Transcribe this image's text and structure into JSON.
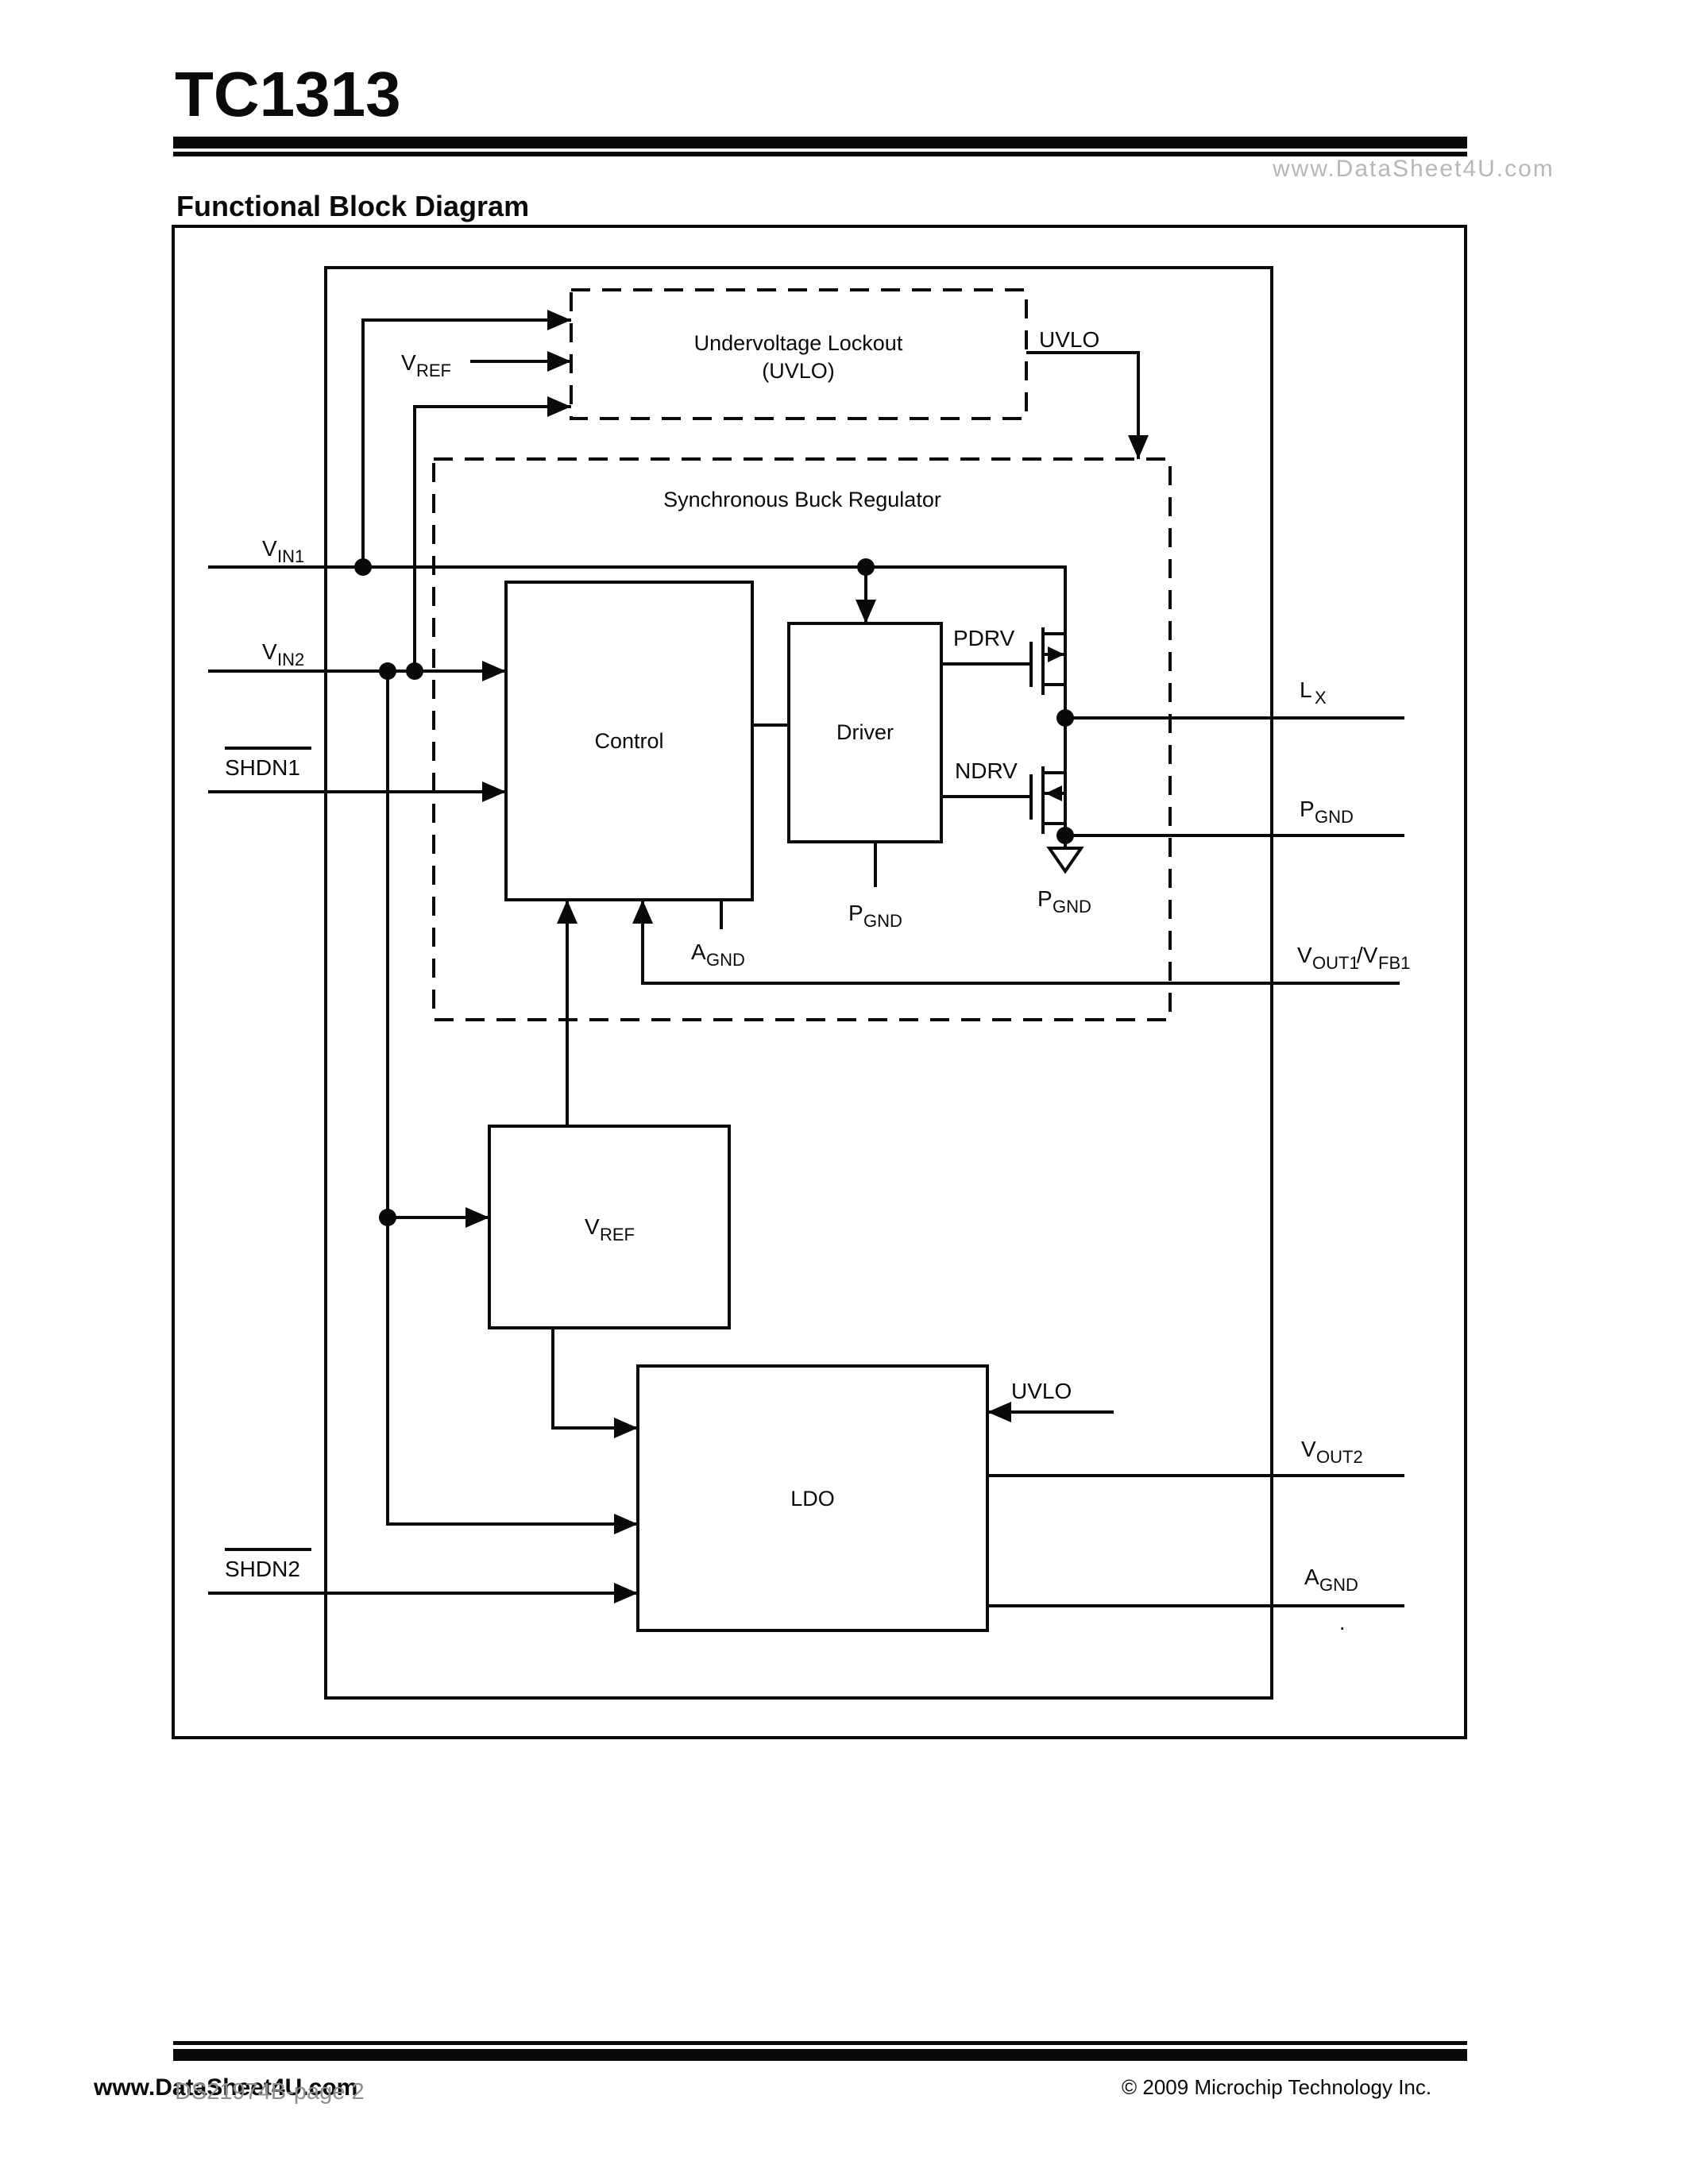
{
  "header": {
    "title": "TC1313",
    "watermark": "www.DataSheet4U.com",
    "section_title": "Functional Block Diagram"
  },
  "blocks": {
    "uvlo_line1": "Undervoltage Lockout",
    "uvlo_line2": "(UVLO)",
    "buck_title": "Synchronous Buck Regulator",
    "control": "Control",
    "driver": "Driver",
    "vref": {
      "main": "V",
      "sub": "REF"
    },
    "ldo": "LDO"
  },
  "pins": {
    "vin1": {
      "main": "V",
      "sub": "IN1"
    },
    "vin2": {
      "main": "V",
      "sub": "IN2"
    },
    "shdn1": "SHDN1",
    "shdn2": "SHDN2",
    "vref_in": {
      "main": "V",
      "sub": "REF"
    },
    "uvlo_out": "UVLO",
    "uvlo_ldo": "UVLO",
    "pdrv": "PDRV",
    "ndrv": "NDRV",
    "lx": {
      "main": "L",
      "sub": "X"
    },
    "pgnd_pin": {
      "main": "P",
      "sub": "GND"
    },
    "pgnd_fet": {
      "main": "P",
      "sub": "GND"
    },
    "pgnd_driver": {
      "main": "P",
      "sub": "GND"
    },
    "agnd_control": {
      "main": "A",
      "sub": "GND"
    },
    "agnd_ldo": {
      "main": "A",
      "sub": "GND"
    },
    "vout1": {
      "m1": "V",
      "s1": "OUT1",
      "m2": "/V",
      "s2": "FB1"
    },
    "vout2": {
      "main": "V",
      "sub": "OUT2"
    },
    "stray_dot": "."
  },
  "footer": {
    "watermark": "www.DataSheet4U.com",
    "page_number": "DS21974B-page 2",
    "copyright": "© 2009 Microchip Technology Inc."
  }
}
